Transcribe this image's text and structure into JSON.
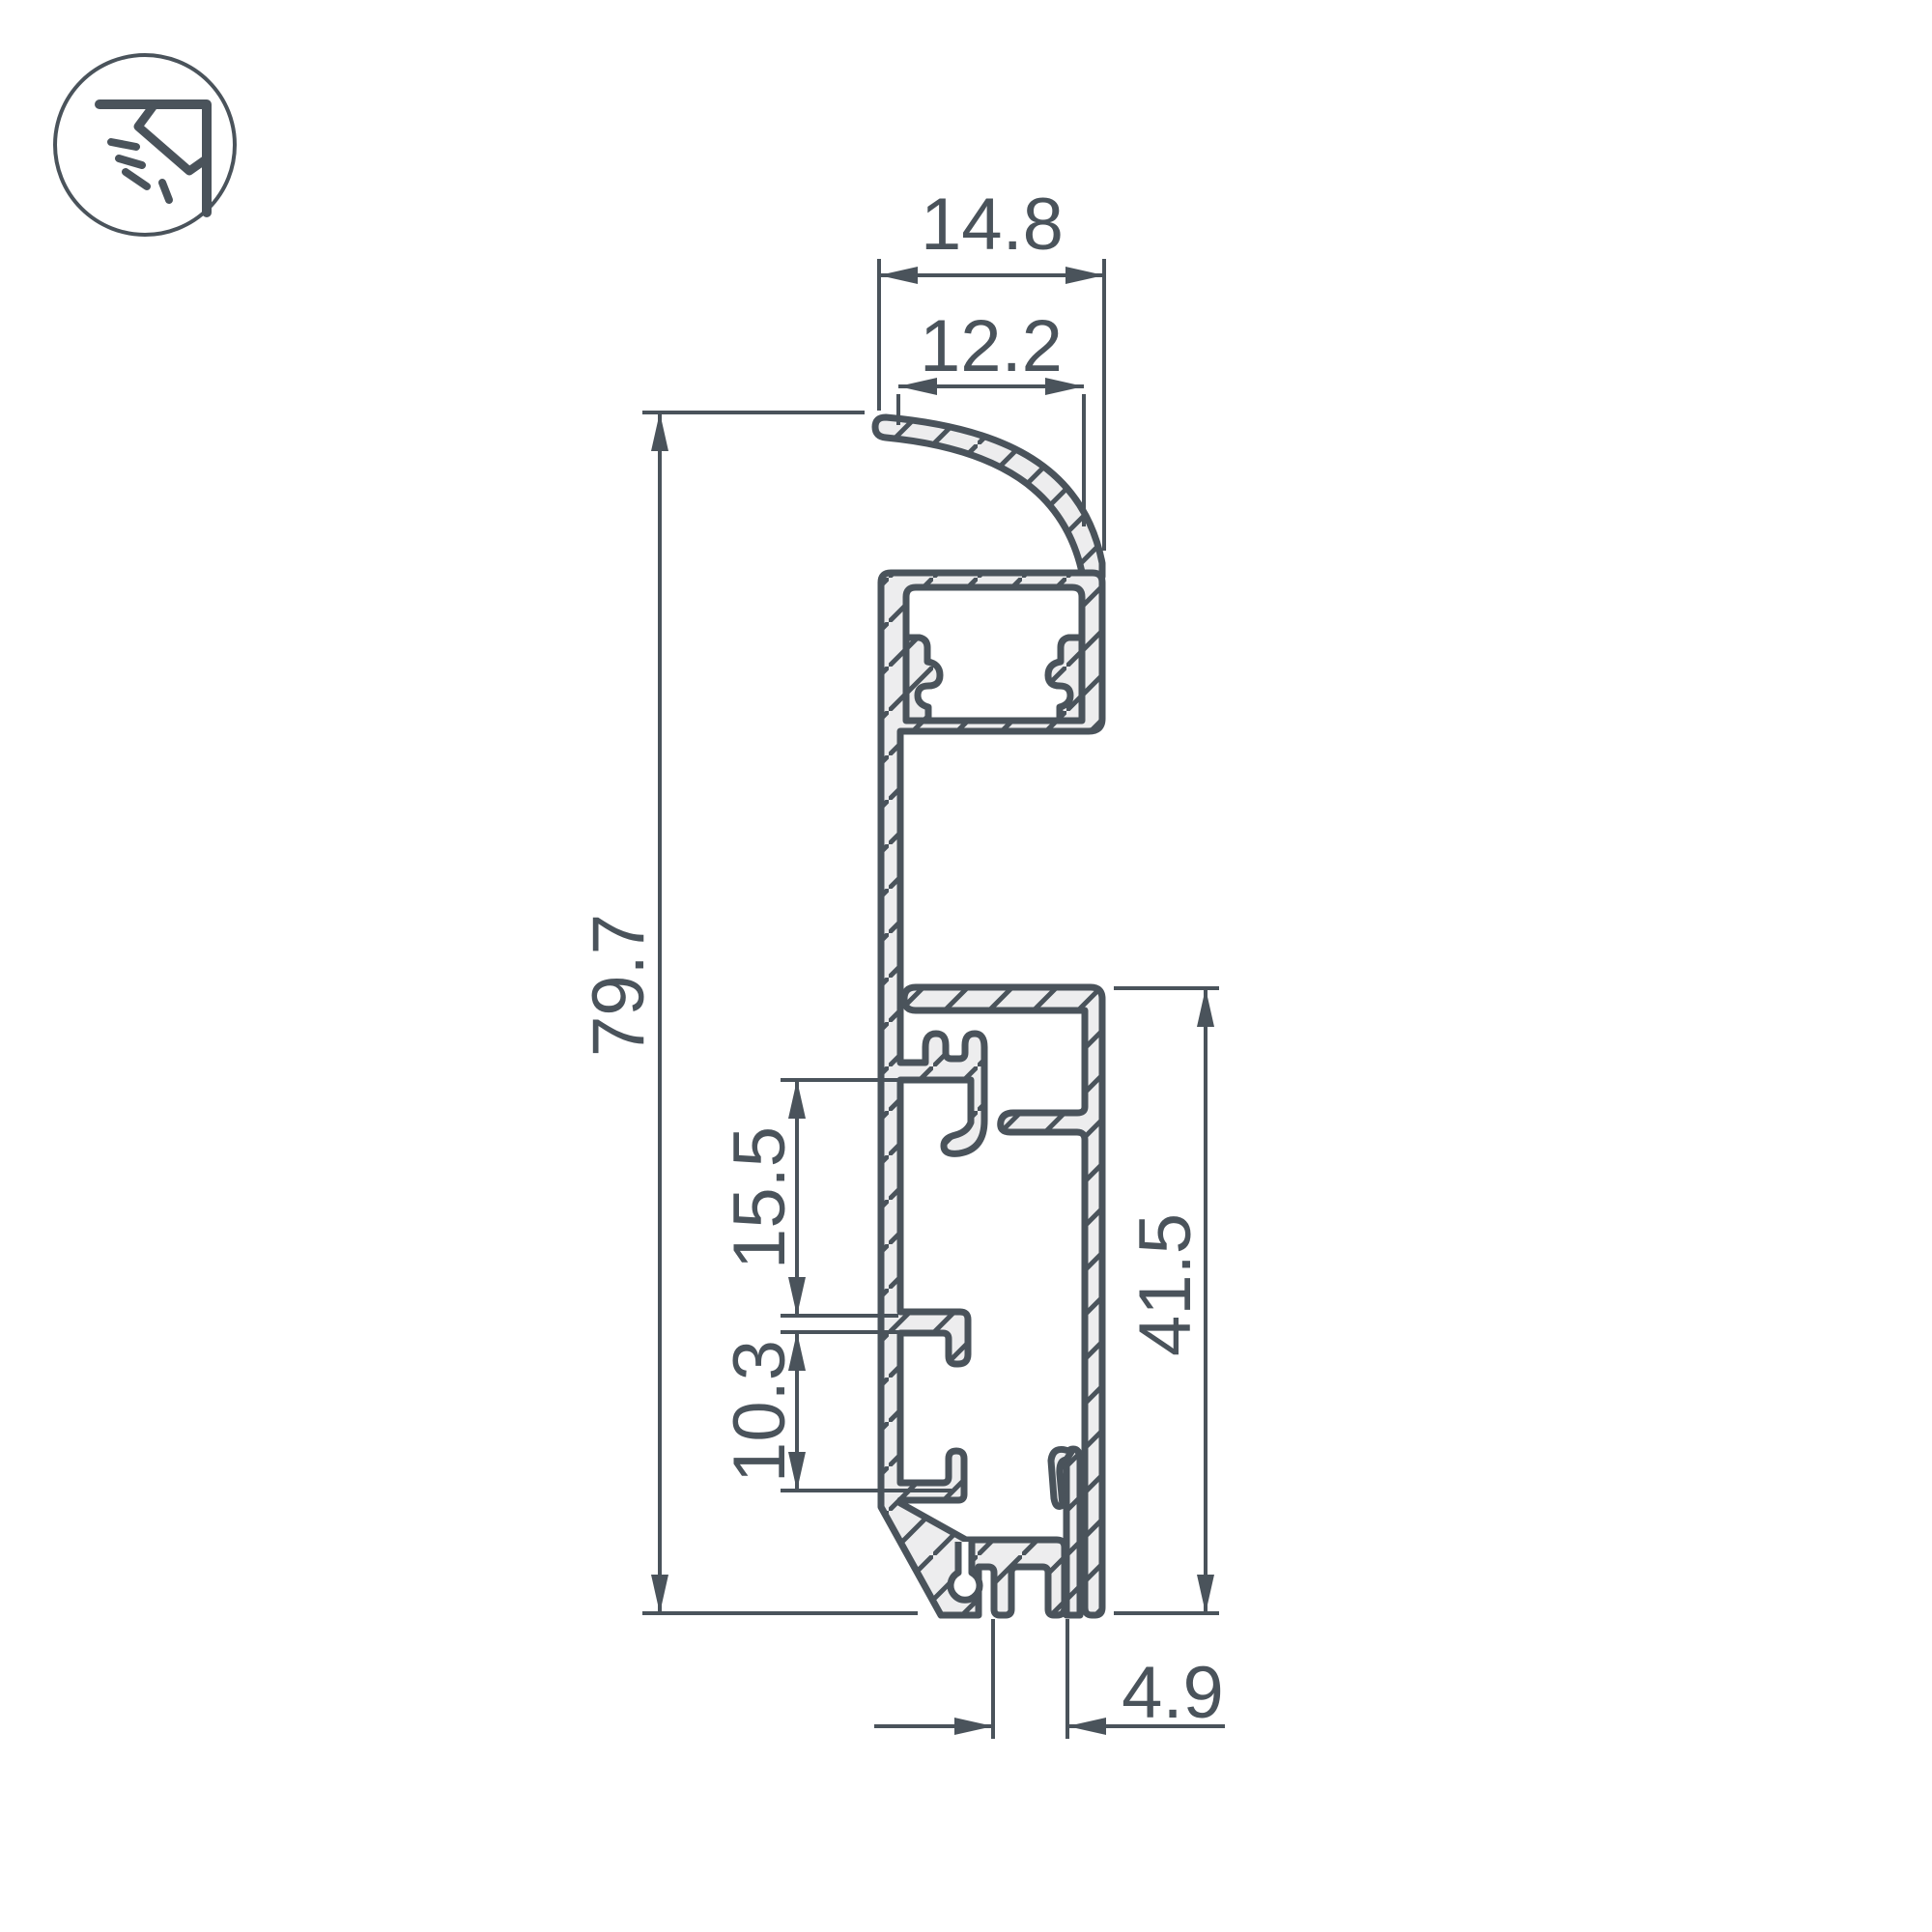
{
  "drawing": {
    "title": "led-profile-cross-section",
    "colors": {
      "line": "#4a535b",
      "metal_fill": "#ededee",
      "background": "#ffffff"
    },
    "icon": {
      "name": "corner-mounted-light-icon"
    },
    "dimensions": {
      "top_outer_width": "14.8",
      "visor_width": "12.2",
      "total_height": "79.7",
      "clip_spacing": "15.5",
      "tab_spacing": "10.3",
      "lower_height": "41.5",
      "foot_slot_width": "4.9"
    }
  }
}
